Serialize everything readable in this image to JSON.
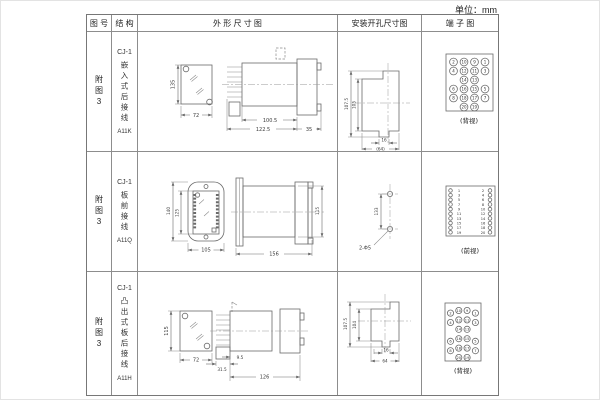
{
  "unit_label": "单位：mm",
  "header": {
    "fig_no": "图 号",
    "structure": "结 构",
    "outline": "外 形 尺 寸 图",
    "mounting": "安装开孔尺寸图",
    "terminal": "端 子 图"
  },
  "rows": [
    {
      "fig_no": "附图3",
      "structure": {
        "top": "CJ-1",
        "mid": "嵌入式后接线",
        "bottom": "A11K"
      },
      "outline": {
        "front_h": "135",
        "front_w": "72",
        "side_d1": "100.5",
        "side_d2": "122.5",
        "side_d3": "35"
      },
      "mounting": {
        "v1": "107.5",
        "v2": "105",
        "h1": "16",
        "h2": "(64)"
      },
      "terminal": {
        "label": "(背视)",
        "grid": [
          [
            2,
            10,
            9,
            1
          ],
          [
            4,
            12,
            11,
            3
          ],
          [
            null,
            14,
            13,
            null
          ],
          [
            6,
            16,
            15,
            5
          ],
          [
            8,
            18,
            17,
            7
          ],
          [
            null,
            20,
            19,
            null
          ]
        ]
      }
    },
    {
      "fig_no": "附图3",
      "structure": {
        "top": "CJ-1",
        "mid": "板前接线",
        "bottom": "A11Q"
      },
      "outline": {
        "front_h1": "140",
        "front_h2": "125",
        "front_w": "105",
        "side_w": "156",
        "side_h": "115"
      },
      "mounting": {
        "v": "133",
        "hole": "2-Φ5"
      },
      "terminal": {
        "label": "(前视)",
        "pairs": [
          [
            1,
            2
          ],
          [
            3,
            4
          ],
          [
            5,
            6
          ],
          [
            7,
            8
          ],
          [
            9,
            10
          ],
          [
            11,
            12
          ],
          [
            13,
            14
          ],
          [
            15,
            16
          ],
          [
            17,
            18
          ],
          [
            19,
            20
          ]
        ]
      }
    },
    {
      "fig_no": "附图3",
      "structure": {
        "top": "CJ-1",
        "mid": "凸出式板后接线",
        "bottom": "A11H"
      },
      "outline": {
        "front_h": "115",
        "front_w": "72",
        "side_d1": "31.5",
        "side_d2": "9.5",
        "side_d3": "126"
      },
      "mounting": {
        "v1": "107.5",
        "v2": "104",
        "h1": "16",
        "h2": "64"
      },
      "terminal": {
        "label": "(背视)",
        "staggered": true,
        "grid": [
          [
            2,
            10,
            9,
            1
          ],
          [
            4,
            12,
            11,
            3
          ],
          [
            null,
            14,
            13,
            null
          ],
          [
            6,
            16,
            15,
            5
          ],
          [
            8,
            18,
            17,
            7
          ],
          [
            null,
            20,
            19,
            null
          ]
        ]
      }
    }
  ]
}
